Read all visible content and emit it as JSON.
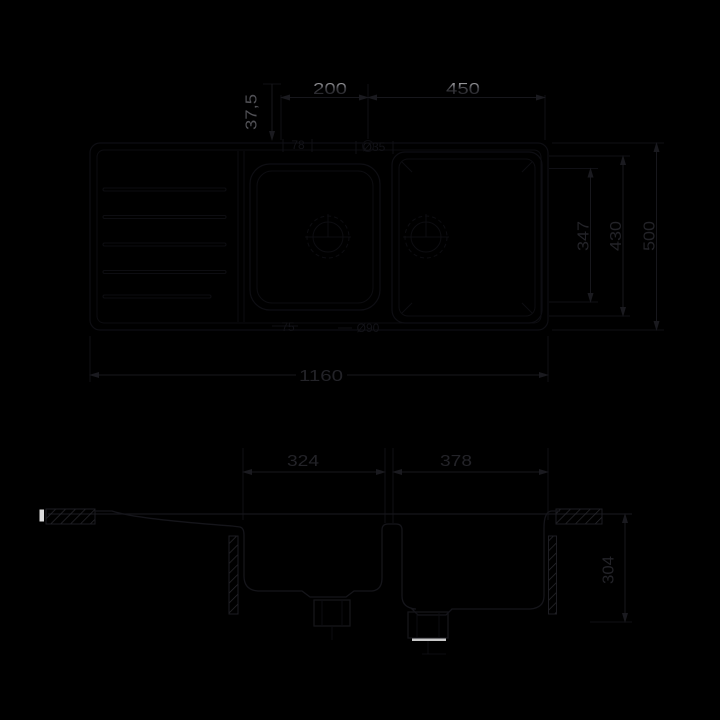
{
  "drawing": {
    "kind": "sink-dimension-drawing",
    "colors": {
      "background": "#000000",
      "outline": "#0e0e13",
      "profile": "#15151a",
      "hatch": "#2b2b31",
      "dim_line": "#17171c",
      "dim_text_dark": "#232328",
      "dim_text_gray": "#515156",
      "text_highlight": "#dedede",
      "white_mark": "#dcdcdc"
    },
    "dims": {
      "span_200": "200",
      "span_450": "450",
      "offset_37_5": "37,5",
      "length_1160": "1160",
      "bowl_324": "324",
      "bowl_378": "378",
      "depth_347": "347",
      "depth_430": "430",
      "depth_500": "500",
      "section_304": "304",
      "annot_78": "78",
      "annot_o35": "Ø35",
      "annot_75": "75",
      "annot_o90": "Ø90"
    }
  }
}
